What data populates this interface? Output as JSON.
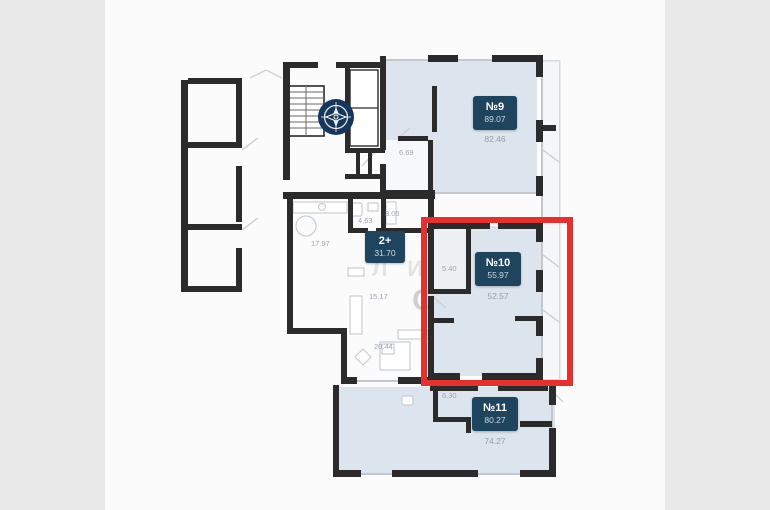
{
  "plan": {
    "units": [
      {
        "number": "№9",
        "total_area": "89.07",
        "second_area": "82.46"
      },
      {
        "number": "№10",
        "total_area": "55.97",
        "second_area": "52.57"
      },
      {
        "number": "№11",
        "total_area": "80.27",
        "second_area": "74.27"
      },
      {
        "number": "2+",
        "total_area": "31.70",
        "second_area": ""
      }
    ],
    "room_areas": [
      "6.69",
      "4.63",
      "3.05",
      "17.97",
      "15.17",
      "20.44",
      "5.40",
      "6.30"
    ],
    "watermark": {
      "line1": "ЛИЯ",
      "line2": "ОСТИ"
    },
    "colors": {
      "highlight_red": "#e6302d",
      "badge_navy": "#1f455e",
      "unit_fill": "#dce4ed",
      "wall": "#2b2b2b",
      "compass_navy": "#16365c"
    },
    "icons": {
      "compass": "compass-rose-icon"
    }
  }
}
